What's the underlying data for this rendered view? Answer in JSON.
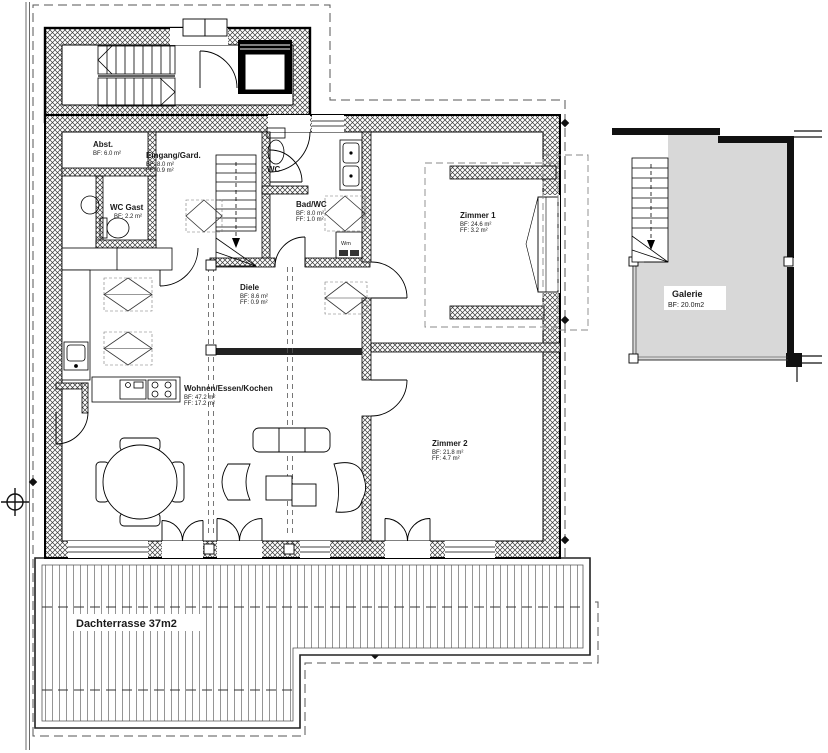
{
  "title": "Dachgeschoss Wohnung Grundriss",
  "colors": {
    "wall_dark": "#111111",
    "galerie_fill": "#d8d8d8",
    "line": "#1a1a1a",
    "paper": "#ffffff"
  },
  "rooms": {
    "abst": {
      "name": "Abst.",
      "bf": "BF: 6.0 m²"
    },
    "eingang": {
      "name": "Eingang/Gard.",
      "bf": "BF: 8.0 m²",
      "ff": "FF: 0.9 m²"
    },
    "wc_gast": {
      "name": "WC Gast",
      "bf": "BF: 2.2 m²"
    },
    "wc": {
      "name": "WC"
    },
    "bad_wc": {
      "name": "Bad/WC",
      "bf": "BF: 8.0 m²",
      "ff": "FF: 1.0 m²"
    },
    "diele": {
      "name": "Diele",
      "bf": "BF: 8.6 m²",
      "ff": "FF: 0.9 m²"
    },
    "zimmer1": {
      "name": "Zimmer 1",
      "bf": "BF: 24.6 m²",
      "ff": "FF: 3.2 m²"
    },
    "wohnen": {
      "name": "Wohnen/Essen/Kochen",
      "bf": "BF: 47.2 m²",
      "ff": "FF: 17.2 m²"
    },
    "zimmer2": {
      "name": "Zimmer 2",
      "bf": "BF: 21.8 m²",
      "ff": "FF: 4.7 m²"
    },
    "galerie": {
      "name": "Galerie",
      "bf": "BF: 20.0m2"
    },
    "dachterrasse": {
      "name": "Dachterrasse 37m2"
    }
  },
  "appliances": {
    "wm_label": "Wm"
  }
}
